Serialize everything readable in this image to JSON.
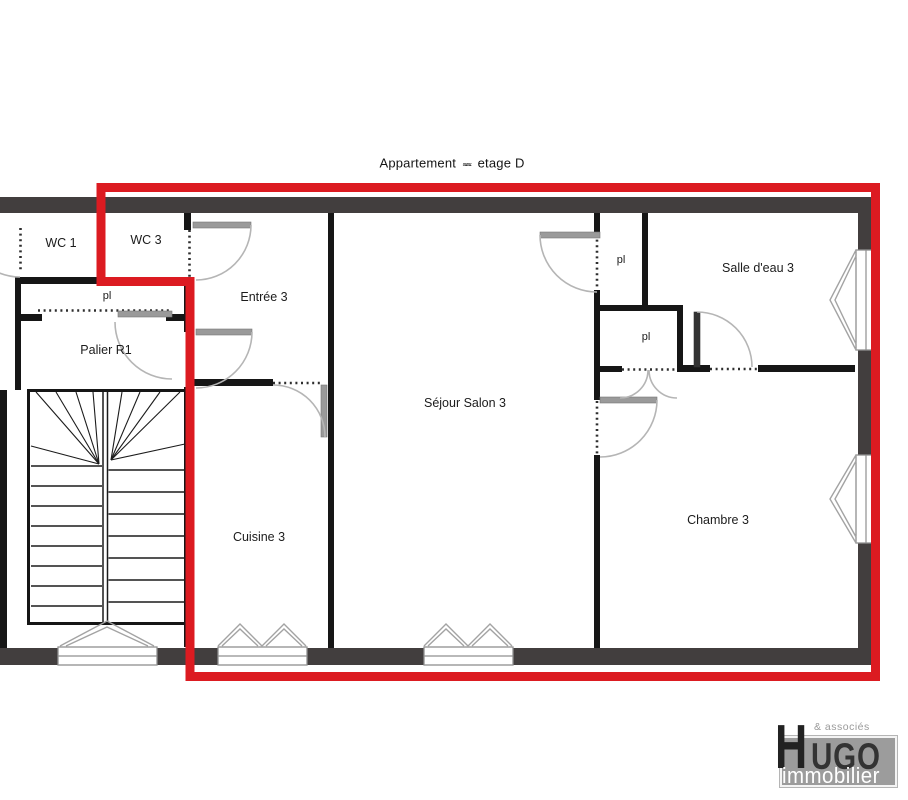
{
  "title": {
    "prefix": "Appartement",
    "redacted": "≈≈",
    "suffix": "etage D"
  },
  "rooms": {
    "wc1": "WC 1",
    "wc3": "WC 3",
    "closet_hall": "pl",
    "palier": "Palier R1",
    "entree": "Entrée 3",
    "cuisine": "Cuisine 3",
    "sejour": "Séjour Salon 3",
    "closet1": "pl",
    "closet2": "pl",
    "salle_eau": "Salle d'eau 3",
    "chambre": "Chambre 3"
  },
  "logo": {
    "brand_initial": "H",
    "brand_rest": "UGO",
    "tagline": "immobilier",
    "associates": "& associés"
  },
  "colors": {
    "apartment_outline": "#dc1b21",
    "outer_wall": "#423e3e",
    "interior_wall": "#161616",
    "door_arc": "#b5b5b5",
    "door_leaf": "#9a9a9a",
    "label_text": "#1c1c1c",
    "logo_box": "#9c9c9c"
  }
}
